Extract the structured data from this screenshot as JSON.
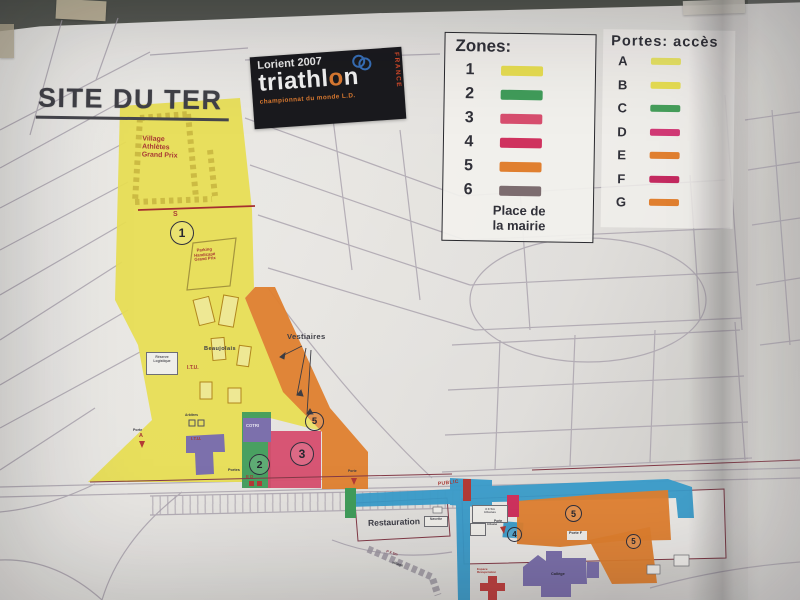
{
  "photo": {
    "wall_color": "#5a5e56",
    "paper_color": "#e9e7e3",
    "tape_color": "#c6bb9b"
  },
  "poster": {
    "title": "SITE DU TER",
    "logo": {
      "top": "Lorient 2007",
      "brand_pre": "triathl",
      "brand_o": "o",
      "brand_post": "n",
      "subtitle": "championnat du monde L.D.",
      "vertical": "FRANCE",
      "bg": "#17171b",
      "accent": "#e87722",
      "rings": "#2e6fc4"
    },
    "zones_legend": {
      "title": "Zones:",
      "items": [
        {
          "label": "1",
          "color": "#ede23e"
        },
        {
          "label": "2",
          "color": "#35a053"
        },
        {
          "label": "3",
          "color": "#e8486e"
        },
        {
          "label": "4",
          "color": "#e22a5e"
        },
        {
          "label": "5",
          "color": "#ee7d1f"
        },
        {
          "label": "6",
          "color": "#7e6b6e"
        }
      ],
      "note": "Place de\nla mairie"
    },
    "portes_legend": {
      "title": "Portes:  accès",
      "items": [
        {
          "label": "A",
          "color": "#ece652"
        },
        {
          "label": "B",
          "color": "#ece23e"
        },
        {
          "label": "C",
          "color": "#3aa253"
        },
        {
          "label": "D",
          "color": "#e43278"
        },
        {
          "label": "E",
          "color": "#ee7d1f"
        },
        {
          "label": "F",
          "color": "#d62160"
        },
        {
          "label": "G",
          "color": "#ee7d1f"
        }
      ]
    },
    "map": {
      "road_blue": "#2b9fd6",
      "building_purple": "#7d6fb5",
      "labels": {
        "village_athletes": "Village\nAthlètes\nGrand Prix",
        "start_s": "S",
        "zone1": "1",
        "parking_handicape": "Parking\nHandicapé\nGrand Prix",
        "beaujolais": "Beaujolais",
        "reserve": "Réserve\nLogistique",
        "itu": "I.T.U.",
        "itu_building": "I.T.U.",
        "arbitres": "Arbitres",
        "cotri": "COTRI",
        "zone2": "2",
        "zone3": "3",
        "vestiaires": "Vestiaires",
        "zone5": "5",
        "porte_word": "Porte",
        "porte_a": "A",
        "portes_word": "Portes",
        "gates_ed": "E  D",
        "restauration": "Restauration",
        "navette": "Navette",
        "public": "PUBLIC",
        "tribunes_box": "3 X 5m\ntribunes",
        "tribune_small": "tribune",
        "zone4": "4",
        "porte_f": "Porte F",
        "zone5b": "5",
        "zone5c": "5",
        "college": "Collège",
        "espace_recup": "Espace\nRécupération",
        "p_x5m": "P X 5m",
        "village_small": "village"
      }
    }
  }
}
